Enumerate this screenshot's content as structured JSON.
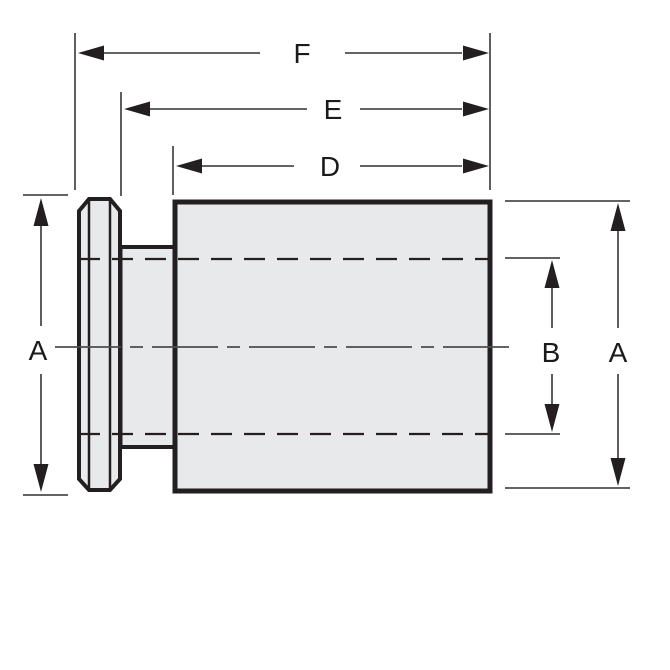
{
  "drawing": {
    "labels": {
      "f": "F",
      "e": "E",
      "d": "D",
      "a_left": "A",
      "b": "B",
      "a_right": "A"
    },
    "colors": {
      "background": "#ffffff",
      "part_fill": "#e8e9ea",
      "part_outline": "#231f20",
      "dimension_line": "#4d4d4d",
      "label_text": "#1a1a1a"
    }
  }
}
